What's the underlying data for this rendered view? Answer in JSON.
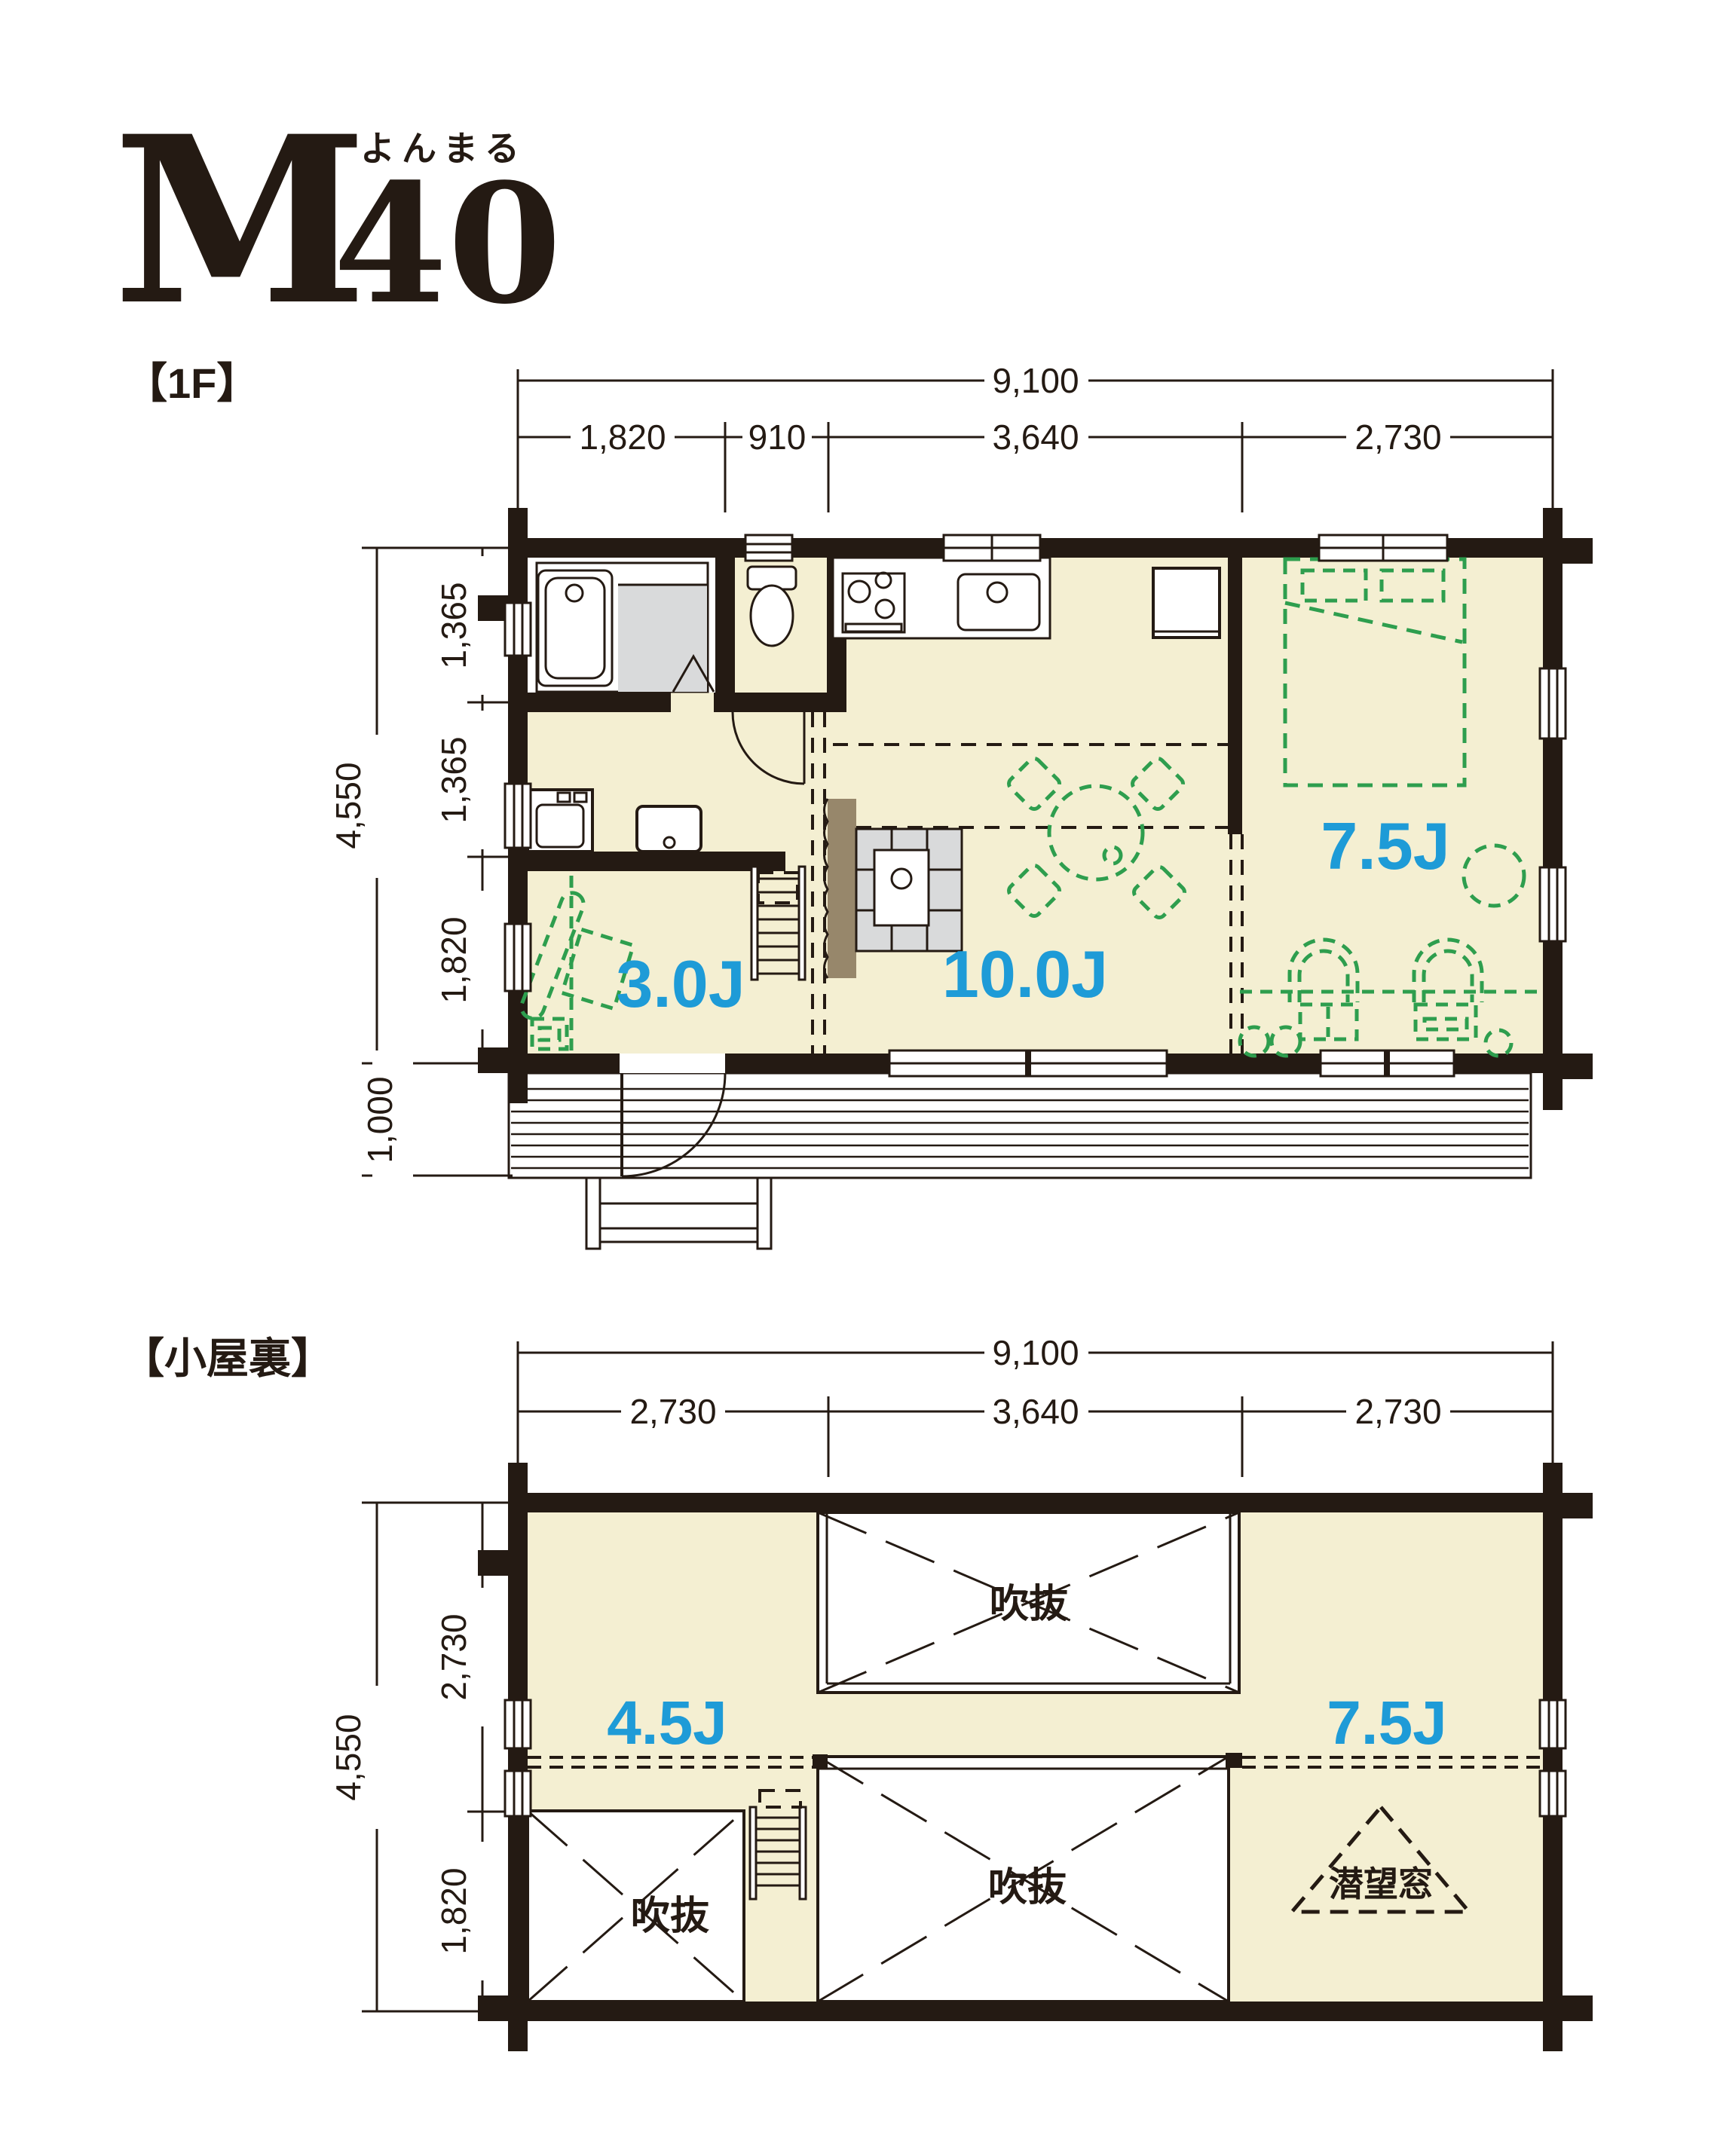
{
  "title": {
    "model_letter": "M",
    "model_number": "40",
    "ruby": "よんまる"
  },
  "colors": {
    "wall": "#241a13",
    "floor": "#f4efd2",
    "deck": "#e9d8ac",
    "shower_gray": "#d9dadb",
    "furniture_green": "#2e9e4e",
    "room_label_blue": "#1e9bd7",
    "chimney_brown": "#97876b"
  },
  "floor1": {
    "section_label": "【1F】",
    "rooms": {
      "entry": "3.0J",
      "living": "10.0J",
      "bedroom": "7.5J"
    },
    "dim_total_width": "9,100",
    "dim_width_segments": [
      "1,820",
      "910",
      "3,640",
      "2,730"
    ],
    "dim_total_height": "4,550",
    "dim_height_segments": [
      "1,365",
      "1,365",
      "1,820"
    ],
    "dim_deck_depth": "1,000"
  },
  "attic": {
    "section_label": "【小屋裏】",
    "rooms": {
      "loft_left": "4.5J",
      "loft_right": "7.5J"
    },
    "void_labels": [
      "吹抜",
      "吹抜",
      "吹抜"
    ],
    "periscope_label": "潜望窓",
    "dim_total_width": "9,100",
    "dim_width_segments": [
      "2,730",
      "3,640",
      "2,730"
    ],
    "dim_total_height": "4,550",
    "dim_height_segments": [
      "2,730",
      "1,820"
    ]
  }
}
